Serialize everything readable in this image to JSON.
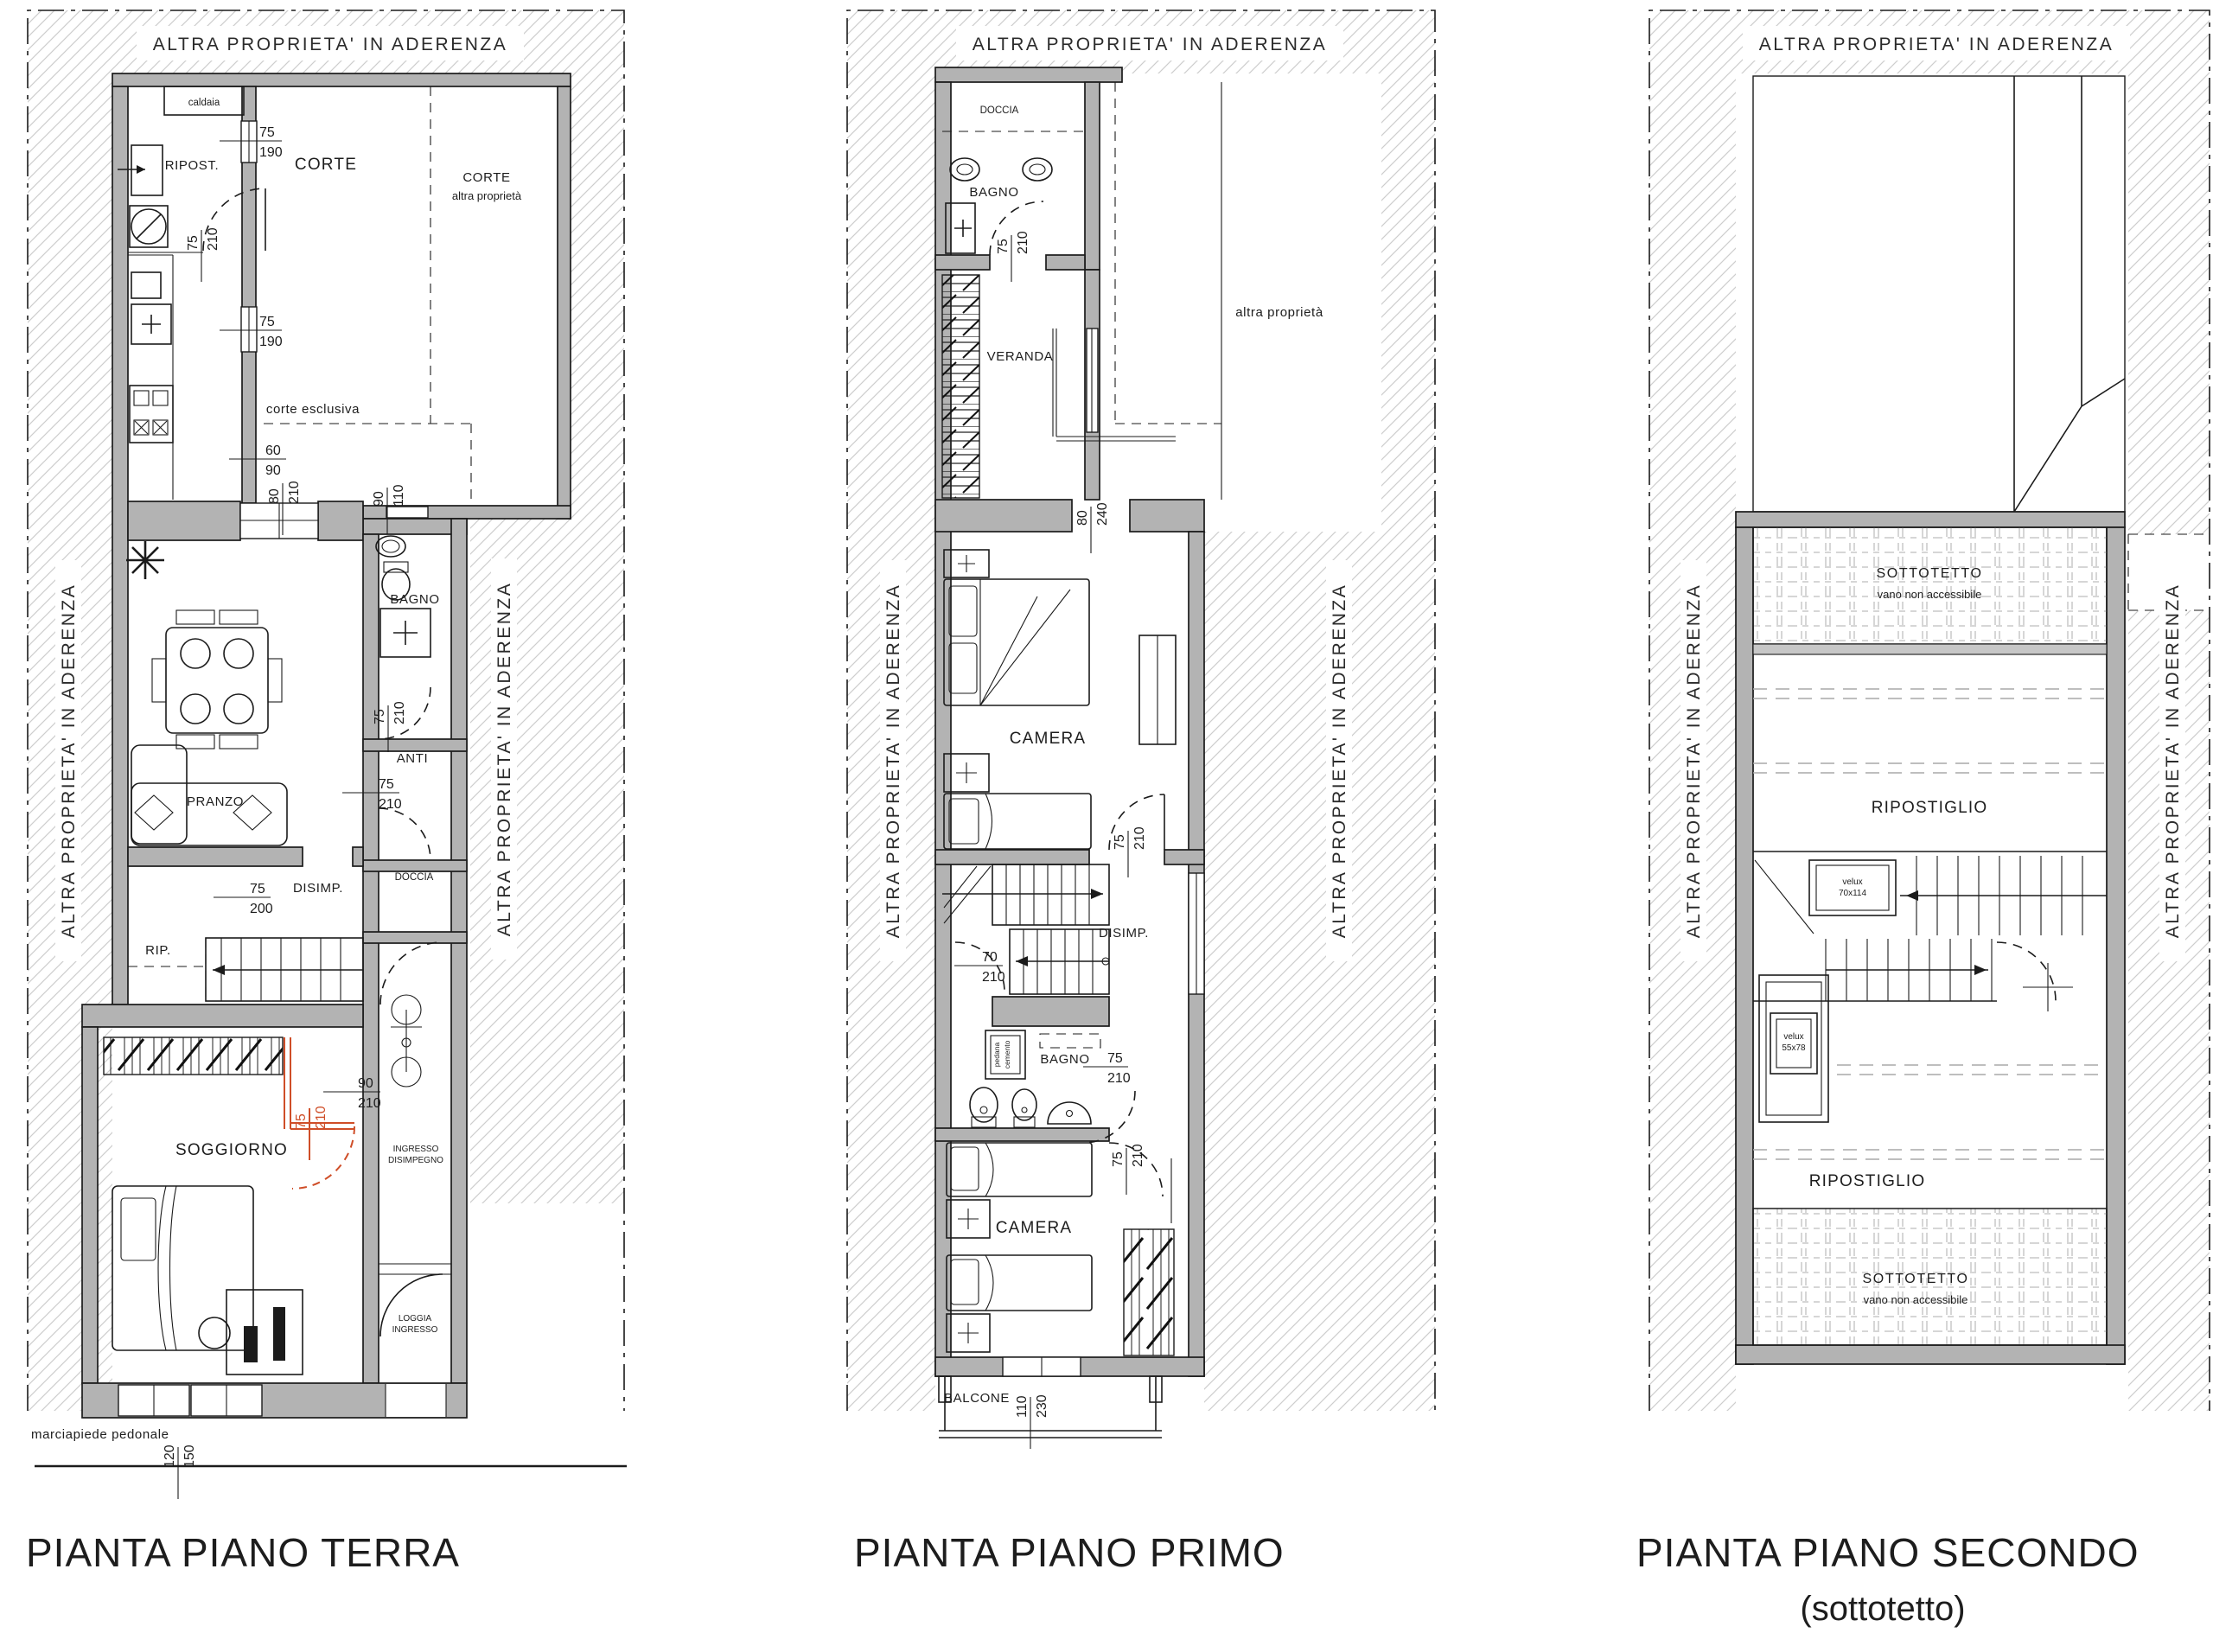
{
  "colors": {
    "wall": "#b3b3b3",
    "line": "#1b1b1b",
    "hatch": "#cdcdcd",
    "accent_red": "#cf4e28"
  },
  "shared": {
    "adjacency_label": "ALTRA PROPRIETA' IN ADERENZA"
  },
  "terra": {
    "title": "PIANTA PIANO TERRA",
    "labels": {
      "caldaia": "caldaia",
      "ripost": "RIPOST.",
      "corte": "CORTE",
      "corte_ap_1": "CORTE",
      "corte_ap_2": "altra proprietà",
      "corte_esclusiva": "corte esclusiva",
      "pranzo": "PRANZO",
      "bagno": "BAGNO",
      "anti": "ANTI",
      "doccia": "DOCCIA",
      "disimp": "DISIMP.",
      "rip": "RIP.",
      "soggiorno": "SOGGIORNO",
      "ingresso_1": "INGRESSO",
      "ingresso_2": "DISIMPEGNO",
      "loggia_1": "LOGGIA",
      "loggia_2": "INGRESSO",
      "marciapiede": "marciapiede pedonale"
    },
    "dims": {
      "win_ripost": {
        "w": "75",
        "h": "190"
      },
      "door_ripost": {
        "w": "75",
        "h": "210"
      },
      "win_cucina": {
        "w": "75",
        "h": "190"
      },
      "gate_corte": {
        "w": "60",
        "h": "90"
      },
      "door_corte": {
        "w": "80",
        "h": "210"
      },
      "win_bagno": {
        "w": "90",
        "h": "110"
      },
      "door_bagno": {
        "w": "75",
        "h": "210"
      },
      "door_anti": {
        "w": "75",
        "h": "210"
      },
      "door_disimp": {
        "w": "75",
        "h": "200"
      },
      "open_soggiorno": {
        "w": "90",
        "h": "210"
      },
      "door_nuova": {
        "w": "75",
        "h": "210"
      },
      "win_soggiorno": {
        "w": "120",
        "h": "150"
      }
    }
  },
  "primo": {
    "title": "PIANTA PIANO PRIMO",
    "labels": {
      "doccia": "DOCCIA",
      "bagno1": "BAGNO",
      "veranda": "VERANDA",
      "altra_proprieta": "altra proprietà",
      "camera1": "CAMERA",
      "disimp": "DISIMP.",
      "bagno2": "BAGNO",
      "nota_1": "pedana",
      "nota_2": "cemento",
      "camera2": "CAMERA",
      "balcone": "BALCONE"
    },
    "dims": {
      "door_bagno1": {
        "w": "75",
        "h": "210"
      },
      "win_camera1": {
        "w": "80",
        "h": "240"
      },
      "door_camera1": {
        "w": "75",
        "h": "210"
      },
      "door_scala": {
        "w": "70",
        "h": "210"
      },
      "door_bagno2": {
        "w": "75",
        "h": "210"
      },
      "door_camera2": {
        "w": "75",
        "h": "210"
      },
      "win_balcone": {
        "w": "110",
        "h": "230"
      }
    }
  },
  "secondo": {
    "title": "PIANTA PIANO SECONDO",
    "subtitle": "(sottotetto)",
    "labels": {
      "sottotetto1_1": "SOTTOTETTO",
      "sottotetto1_2": "vano non accessibile",
      "ripostiglio1": "RIPOSTIGLIO",
      "velux1_1": "velux",
      "velux1_2": "70x114",
      "velux2_1": "velux",
      "velux2_2": "55x78",
      "ripostiglio2": "RIPOSTIGLIO",
      "sottotetto2_1": "SOTTOTETTO",
      "sottotetto2_2": "vano non accessibile"
    }
  }
}
